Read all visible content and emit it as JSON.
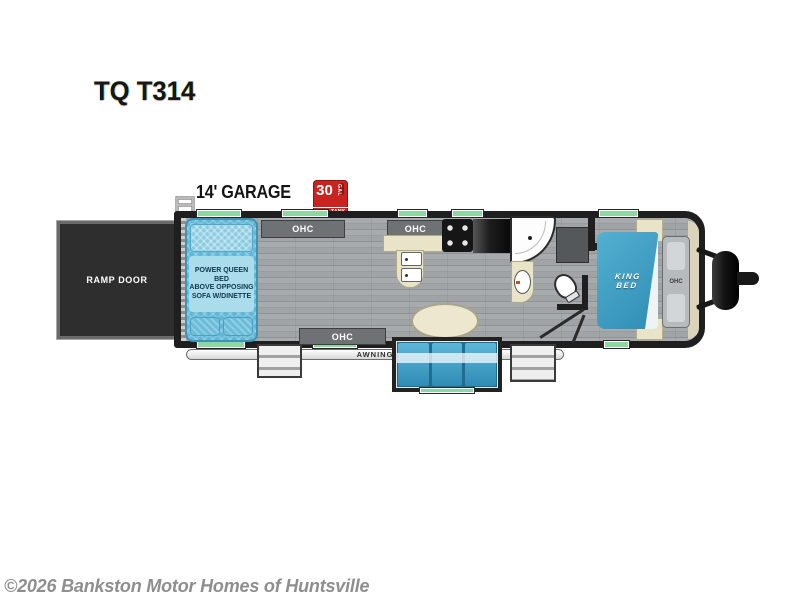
{
  "model": {
    "title": "TQ T314"
  },
  "garage": {
    "label": "14' GARAGE"
  },
  "fuel_tank": {
    "capacity": "30",
    "unit": "GAL",
    "label": "FUEL TANK"
  },
  "floorplan": {
    "ramp_door": "RAMP DOOR",
    "queen_bed": {
      "line1": "POWER QUEEN BED",
      "line2": "ABOVE OPPOSING",
      "line3": "SOFA W/DINETTE"
    },
    "king_bed": {
      "line1": "KING",
      "line2": "BED"
    },
    "ohc": "OHC",
    "awning": "AWNING"
  },
  "footer": {
    "copyright": "©2026 Bankston Motor Homes of Huntsville"
  },
  "colors": {
    "wall": "#1f1f1f",
    "floor": "#9fa2a5",
    "window_green": "#8ed6a2",
    "ramp_door": "#2e2e2e",
    "bed_blue": "#5fb6d6",
    "bed_panel": "#aadcec",
    "king_bed_blue": "#2f8db4",
    "sofa_blue": "#2f8cb4",
    "counter_tan": "#e9e4c8",
    "cabinet_gray": "#6e7275",
    "fuel_red": "#c9241f",
    "copyright_gray": "#8e8e8e"
  }
}
